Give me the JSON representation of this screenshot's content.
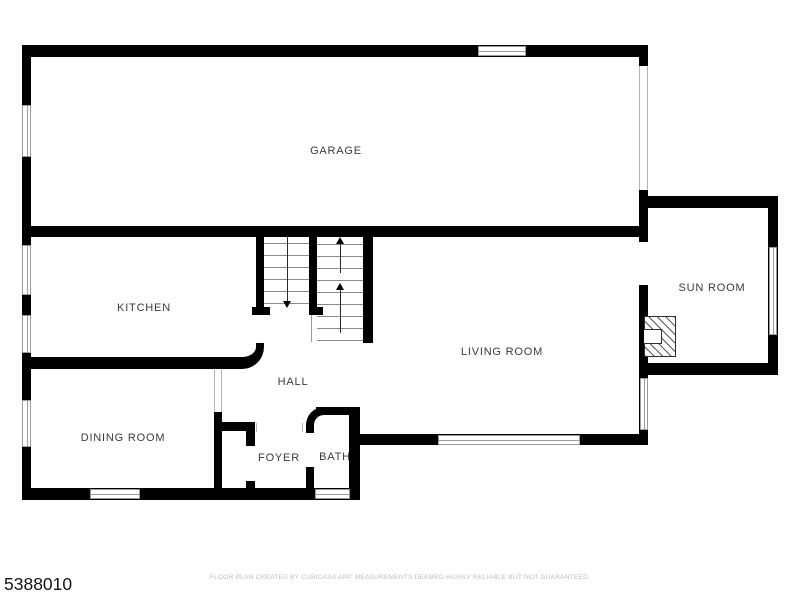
{
  "plan": {
    "rooms": {
      "garage": {
        "label": "GARAGE"
      },
      "kitchen": {
        "label": "KITCHEN"
      },
      "dining_room": {
        "label": "DINING ROOM"
      },
      "hall": {
        "label": "HALL"
      },
      "foyer": {
        "label": "FOYER"
      },
      "bath": {
        "label": "BATH"
      },
      "living_room": {
        "label": "LIVING ROOM"
      },
      "sun_room": {
        "label": "SUN ROOM"
      }
    },
    "features": {
      "staircase": {
        "upper_flight_direction": "up",
        "lower_flight_direction": "down"
      },
      "fireplace": true,
      "garage_door_side": "right"
    },
    "colors": {
      "wall": "#000000",
      "opening_line": "#b4b4b4",
      "tread_line": "#8a8a8a",
      "label_text": "#3a3a3a",
      "disclaimer_text": "#bdbdbd",
      "listing_id_text": "#141414"
    }
  },
  "footer": {
    "listing_id": "5388010",
    "disclaimer": "FLOOR PLAN CREATED BY CUBICASA APP. MEASUREMENTS DEEMED HIGHLY RELIABLE BUT NOT GUARANTEED."
  }
}
